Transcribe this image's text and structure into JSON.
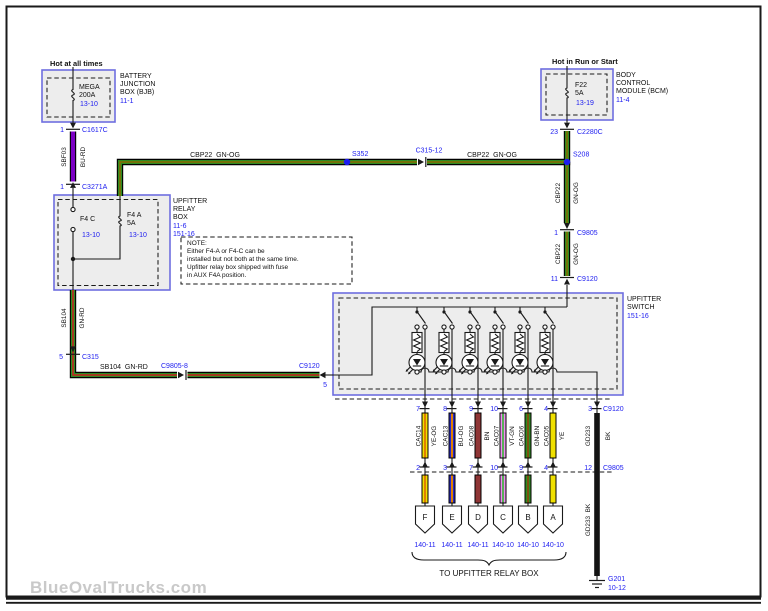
{
  "watermark": "BlueOvalTrucks.com",
  "colors": {
    "green": "#2e8b22",
    "orange_stripe": "#8a6b00",
    "red_stripe": "#cc2020",
    "purple": "#7c00c4"
  },
  "power_left": {
    "header": "Hot at all times",
    "fuse_name": "MEGA",
    "fuse_rating": "200A",
    "fuse_page": "13-10",
    "box_line1": "BATTERY",
    "box_line2": "JUNCTION",
    "box_line3": "BOX (BJB)",
    "box_page": "11-1",
    "conn_top_pin": "1",
    "conn_top_name": "C1617C",
    "wire_circuit": "SBF03",
    "wire_color": "BU-RD",
    "conn_bottom_pin": "1",
    "conn_bottom_name": "C3271A"
  },
  "power_right": {
    "header": "Hot in Run or Start",
    "fuse_name": "F22",
    "fuse_rating": "5A",
    "fuse_page": "13-19",
    "box_line1": "BODY",
    "box_line2": "CONTROL",
    "box_line3": "MODULE (BCM)",
    "box_page": "11-4",
    "conn_pin": "23",
    "conn_name": "C2280C"
  },
  "main_run": {
    "label_left": "CBP22  GN-OG",
    "splice_left": "S352",
    "inline_conn": "C315-12",
    "label_right": "CBP22  GN-OG",
    "splice_right": "S208"
  },
  "right_drop": {
    "seg1_circuit": "CBP22",
    "seg1_color": "GN-OG",
    "conn1_pin": "1",
    "conn1_name": "C9805",
    "seg2_circuit": "CBP22",
    "seg2_color": "GN-OG",
    "conn2_pin": "11",
    "conn2_name": "C9120"
  },
  "relay_box": {
    "fuse_c_label": "F4 C",
    "fuse_c_page": "13-10",
    "fuse_a_label": "F4 A",
    "fuse_a_rating": "5A",
    "fuse_a_page": "13-10",
    "name_line1": "UPFITTER",
    "name_line2": "RELAY",
    "name_line3": "BOX",
    "page1": "11-6",
    "page2": "151-16"
  },
  "note": {
    "line1": "NOTE:",
    "line2": "Either F4-A or F4-C can be",
    "line3": "installed but not both at the same time.",
    "line4": "Upfitter relay box shipped with fuse",
    "line5": "in AUX F4A position."
  },
  "left_run": {
    "wire_circuit": "SB104",
    "wire_color": "GN-RD",
    "conn_pin": "5",
    "conn_name": "C315",
    "wire_label": "SB104  GN-RD",
    "inline_conn": "C9805-8",
    "entry_conn_name": "C9120",
    "entry_conn_pin": "5"
  },
  "switch_box": {
    "name_line1": "UPFITTER",
    "name_line2": "SWITCH",
    "page": "151-16"
  },
  "outputs": {
    "conn_top_name": "C9120",
    "conn_bottom_name": "C9805",
    "wires": [
      {
        "pin_top": "7",
        "circuit": "CAC14",
        "color": "YE-OG",
        "pin_bottom": "2",
        "letter": "F",
        "page": "140-11",
        "base": "#f0e000",
        "stripe": "#e08000"
      },
      {
        "pin_top": "8",
        "circuit": "CAC13",
        "color": "BU-OG",
        "pin_bottom": "3",
        "letter": "E",
        "page": "140-11",
        "base": "#2828cc",
        "stripe": "#e08000"
      },
      {
        "pin_top": "9",
        "circuit": "CAC08",
        "color": "BN",
        "pin_bottom": "7",
        "letter": "D",
        "page": "140-11",
        "base": "#8f3535",
        "stripe": "#8f3535"
      },
      {
        "pin_top": "10",
        "circuit": "CAC07",
        "color": "VT-GN",
        "pin_bottom": "10",
        "letter": "C",
        "page": "140-10",
        "base": "#ef8fef",
        "stripe": "#58b058"
      },
      {
        "pin_top": "6",
        "circuit": "CAC06",
        "color": "GN-BN",
        "pin_bottom": "9",
        "letter": "B",
        "page": "140-10",
        "base": "#2e8b22",
        "stripe": "#7a5210"
      },
      {
        "pin_top": "4",
        "circuit": "CAC05",
        "color": "YE",
        "pin_bottom": "4",
        "letter": "A",
        "page": "140-10",
        "base": "#f0e000",
        "stripe": "#f0e000"
      }
    ],
    "ground": {
      "pin_top": "3",
      "circuit": "GD233",
      "color": "BK",
      "pin_bottom": "12",
      "label_lower": "GD233  BK",
      "name": "G201",
      "page": "10-12",
      "base": "#141414"
    },
    "caption": "TO UPFITTER RELAY BOX"
  }
}
